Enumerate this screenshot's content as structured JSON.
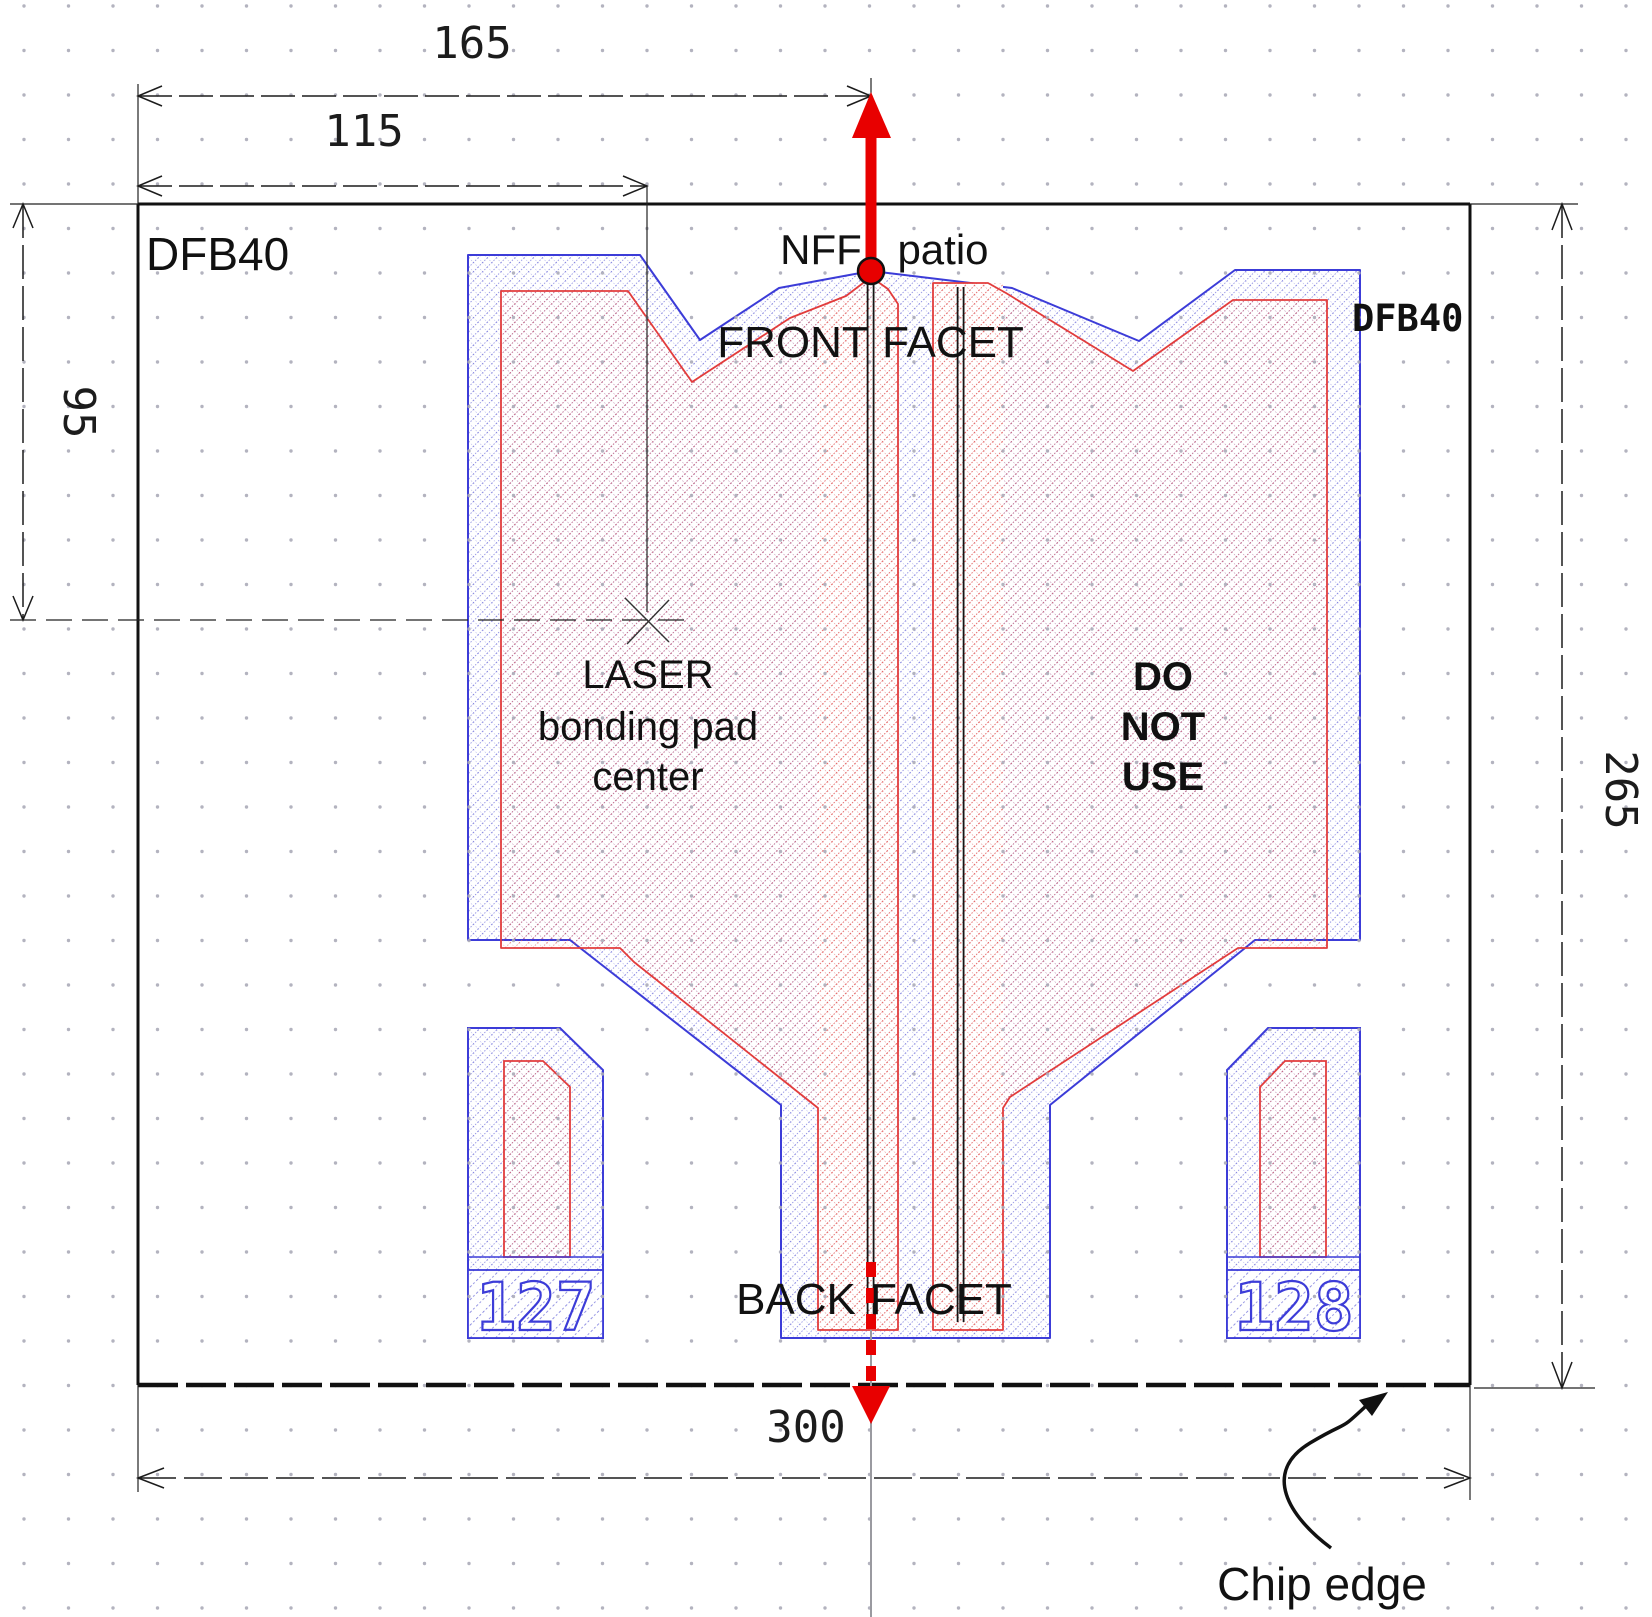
{
  "chip": {
    "name": "DFB40"
  },
  "labels": {
    "nff": "NFF",
    "patio": "patio",
    "front": "FRONT",
    "facet_front": "FACET",
    "back": "BACK",
    "facet_back": "FACET",
    "laser_line1": "LASER",
    "laser_line2": "bonding pad",
    "laser_line3": "center",
    "dnu_line1": "DO",
    "dnu_line2": "NOT",
    "dnu_line3": "USE",
    "chip_edge": "Chip edge"
  },
  "dimensions": {
    "front_facet_offset": "165",
    "bond_pad_x": "115",
    "bond_pad_y": "95",
    "chip_height": "265",
    "chip_width": "300"
  },
  "pad_numbers": {
    "left": "127",
    "right": "128"
  },
  "colors": {
    "metal_blue": "#3c3cd8",
    "contact_red": "#e23c3c",
    "marker_red": "#e80000",
    "outline_black": "#111111",
    "grid_dot_gray": "#aaaab8"
  }
}
